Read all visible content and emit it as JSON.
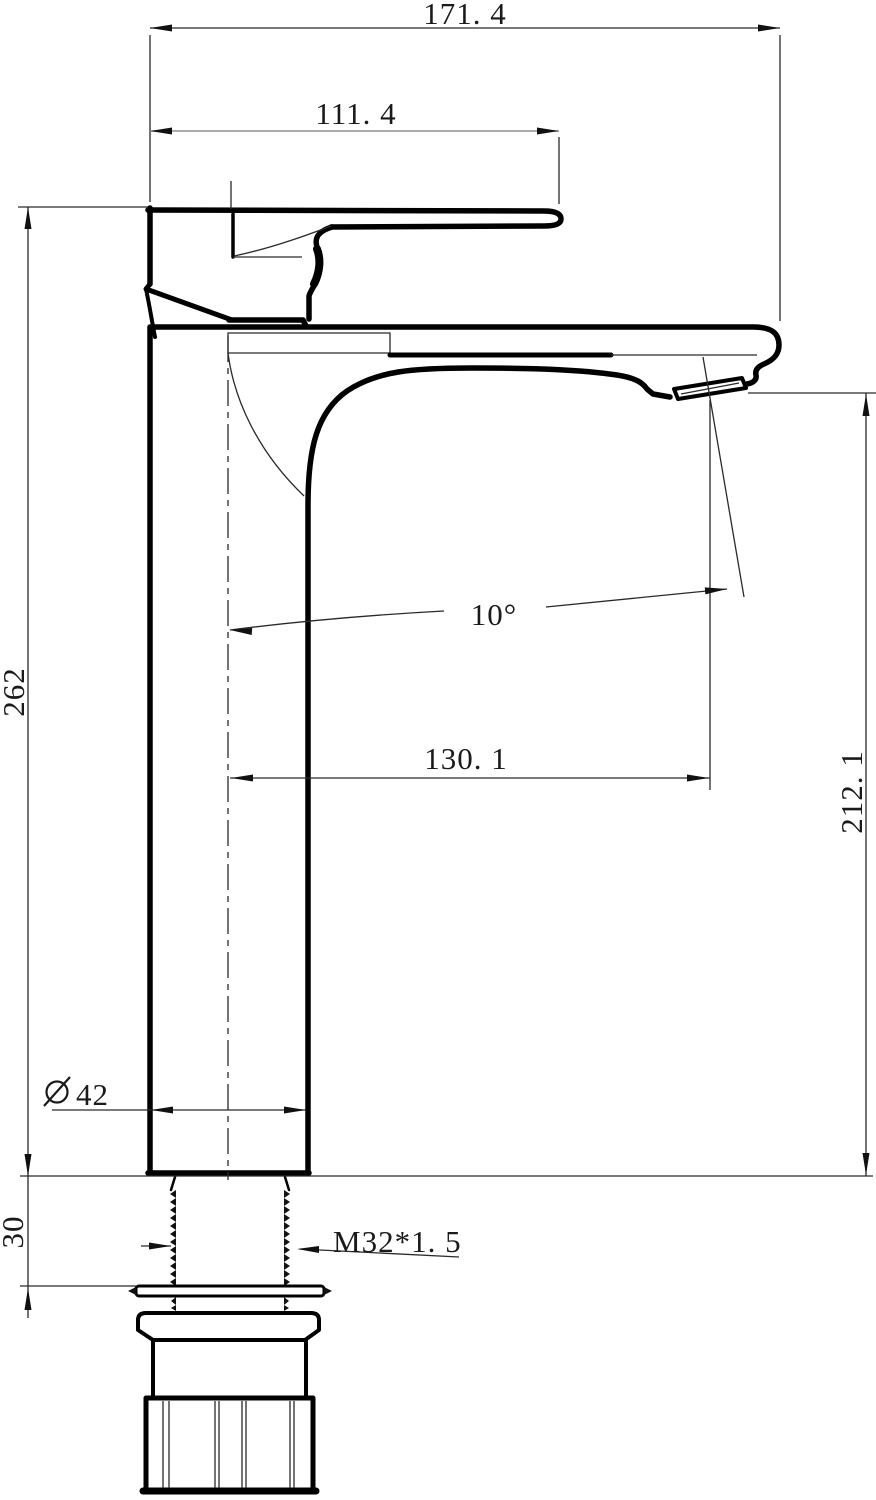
{
  "drawing": {
    "background": "#ffffff",
    "line_color": "#000000",
    "dim_line_color": "#2a2a2a",
    "secondary_dim_line_color": "#8f8f8f"
  },
  "dims": {
    "overall_width": "171. 4",
    "handle_length": "111. 4",
    "overall_height": "262",
    "outlet_height": "212. 1",
    "outlet_reach": "130. 1",
    "outlet_angle": "10°",
    "diameter_symbol_name": "diameter",
    "body_diameter": "42",
    "shank_length": "30",
    "thread_spec": "M32*1. 5"
  }
}
